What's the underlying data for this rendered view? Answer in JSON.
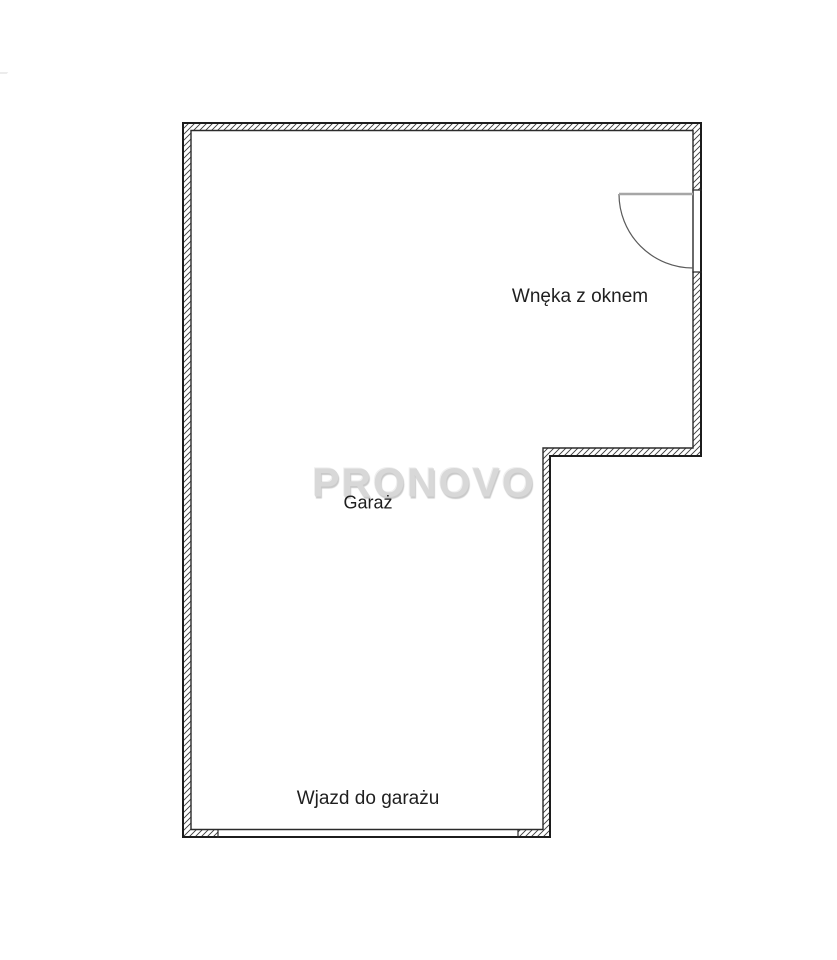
{
  "window": {
    "width": 837,
    "height": 960,
    "background": "#ffffff"
  },
  "floorplan": {
    "watermark": {
      "text": "PRONOVO",
      "color": "#d8d8d8"
    },
    "labels": {
      "alcove": "Wnęka z oknem",
      "garage": "Garaż",
      "entrance": "Wjazd do garażu"
    },
    "colors": {
      "wall_outer_line": "#1c1c1c",
      "wall_inner_line": "#2b2b2b",
      "hatch_line": "#3a3a3a",
      "opening_cap_line": "#2b2b2b",
      "door_leaf": "#a6a6a6",
      "door_arc": "#5a5a5a",
      "label_text": "#1f1f1f",
      "background": "#ffffff"
    },
    "features": {
      "door_swing": "quarter-circle-door-swing-right-wall",
      "garage_opening": "bottom-wall-garage-entry-opening"
    }
  }
}
